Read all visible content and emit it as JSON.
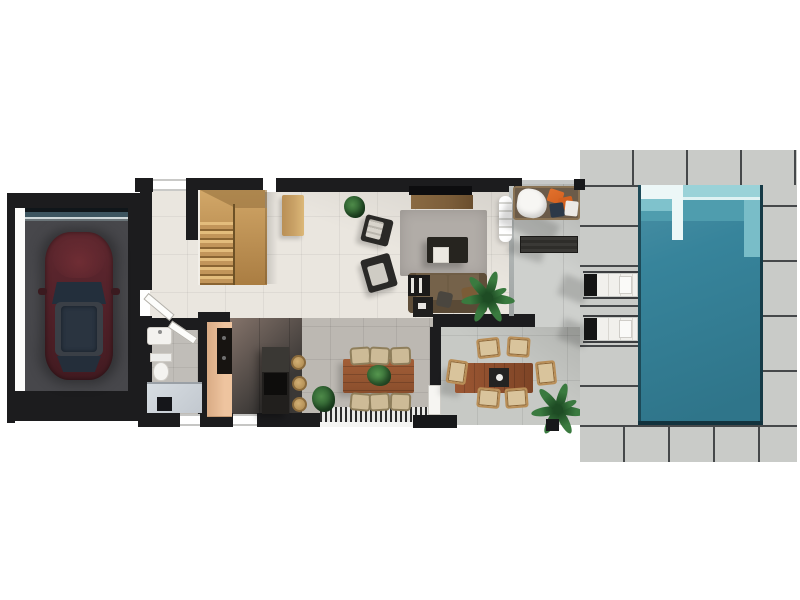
{
  "scene": {
    "type": "architectural-floor-plan",
    "view": "top-down-3d-render",
    "floor": "ground floor of a villa with pool",
    "rooms": [
      {
        "name": "Garage",
        "items": [
          "dark-red car parked facing up",
          "concrete floor",
          "sectional garage door at top"
        ]
      },
      {
        "name": "Entry Hall",
        "items": [
          "two open white door leaves",
          "door to garage"
        ]
      },
      {
        "name": "Staircase",
        "items": [
          "u-shaped wooden staircase with landing and treads"
        ]
      },
      {
        "name": "Living Room",
        "items": [
          "wall TV and wood media console",
          "gray area rug",
          "dark coffee table",
          "white ottoman cube",
          "olive-brown sofa with pillows",
          "black shelf unit",
          "black side table",
          "two dark armchairs",
          "wooden console table",
          "small potted plant",
          "indoor palm plant",
          "white curtain on glass wall"
        ]
      },
      {
        "name": "Kitchen",
        "items": [
          "tan cabinet run with black cooktop counter",
          "dark island with cooktop",
          "three round rattan bar stools",
          "dark tile floor"
        ]
      },
      {
        "name": "Bathroom",
        "items": [
          "washbasin",
          "toilet",
          "walk-in shower with dark drain"
        ]
      },
      {
        "name": "Dining Room",
        "items": [
          "wooden dining table for six",
          "six beige chairs",
          "green plant centerpiece",
          "louvered window strip on south wall"
        ]
      },
      {
        "name": "Side Terrace",
        "items": [
          "daybed with white blanket, orange and navy pillows",
          "dark slatted outdoor bench"
        ]
      },
      {
        "name": "Outdoor Dining Terrace",
        "items": [
          "wooden outdoor table for six",
          "dark centerpiece runner with white bowl",
          "white pillar",
          "black planter box",
          "palm plant"
        ]
      },
      {
        "name": "Pool Deck",
        "items": [
          "rectangular teal swimming pool",
          "white corner entry steps",
          "shallow shelf along top edge",
          "two white sun loungers with black headrests",
          "large concrete pavers"
        ]
      }
    ]
  },
  "colors": {
    "wall": "#1c1c1e",
    "living_floor": "#eae6df",
    "dining_floor": "#bcb8b2",
    "bath_floor": "#c0bdb8",
    "kitchen_floor_dark": "#3b3836",
    "kitchen_floor_light": "#84736a",
    "cabinet_wood": "#eec49f",
    "cooktop_black": "#171411",
    "island_dark": "#211f1d",
    "island_top": "#3a3834",
    "stool_tan": "#cfa96c",
    "stairs_wood_light": "#d2a768",
    "stairs_wood_dark": "#a87c42",
    "console_wood": "#c9a267",
    "rug_gray": "#b1aca7",
    "sofa_olive": "#6f5d45",
    "furn_dark": "#26241f",
    "ottoman_white": "#ebe8e1",
    "tv_black": "#0d0d0f",
    "tv_console_wood": "#7c5e3a",
    "table_wood": "#9b5a35",
    "chair_indoor": "#cdbb97",
    "chair_outdoor": "#b98e57",
    "terrace_concrete": "#c7c9c5",
    "side_terrace": "#ced0cd",
    "deck_concrete": "#c9cbc8",
    "grout": "#45484a",
    "pool_main": "#37849b",
    "pool_shelf": "#4f9dae",
    "pool_light": "#9ad2d8",
    "pool_step_white": "#ecf7f7",
    "pool_edge_dark": "#1d4a58",
    "lounger_white": "#f1f0ec",
    "lounger_black": "#141414",
    "garage_floor": "#47474b",
    "garage_door": "#3d5560",
    "car_body": "#53222a",
    "car_glass": "#2a3440",
    "daybed_base": "#6b5b49",
    "blanket_white": "#f7f6f3",
    "pillow_orange": "#d2601f",
    "pillow_navy": "#2c3948",
    "bench_dark": "#2e2d2a",
    "plant_green": "#3a7a3f",
    "plant_dark": "#1e4c24"
  }
}
